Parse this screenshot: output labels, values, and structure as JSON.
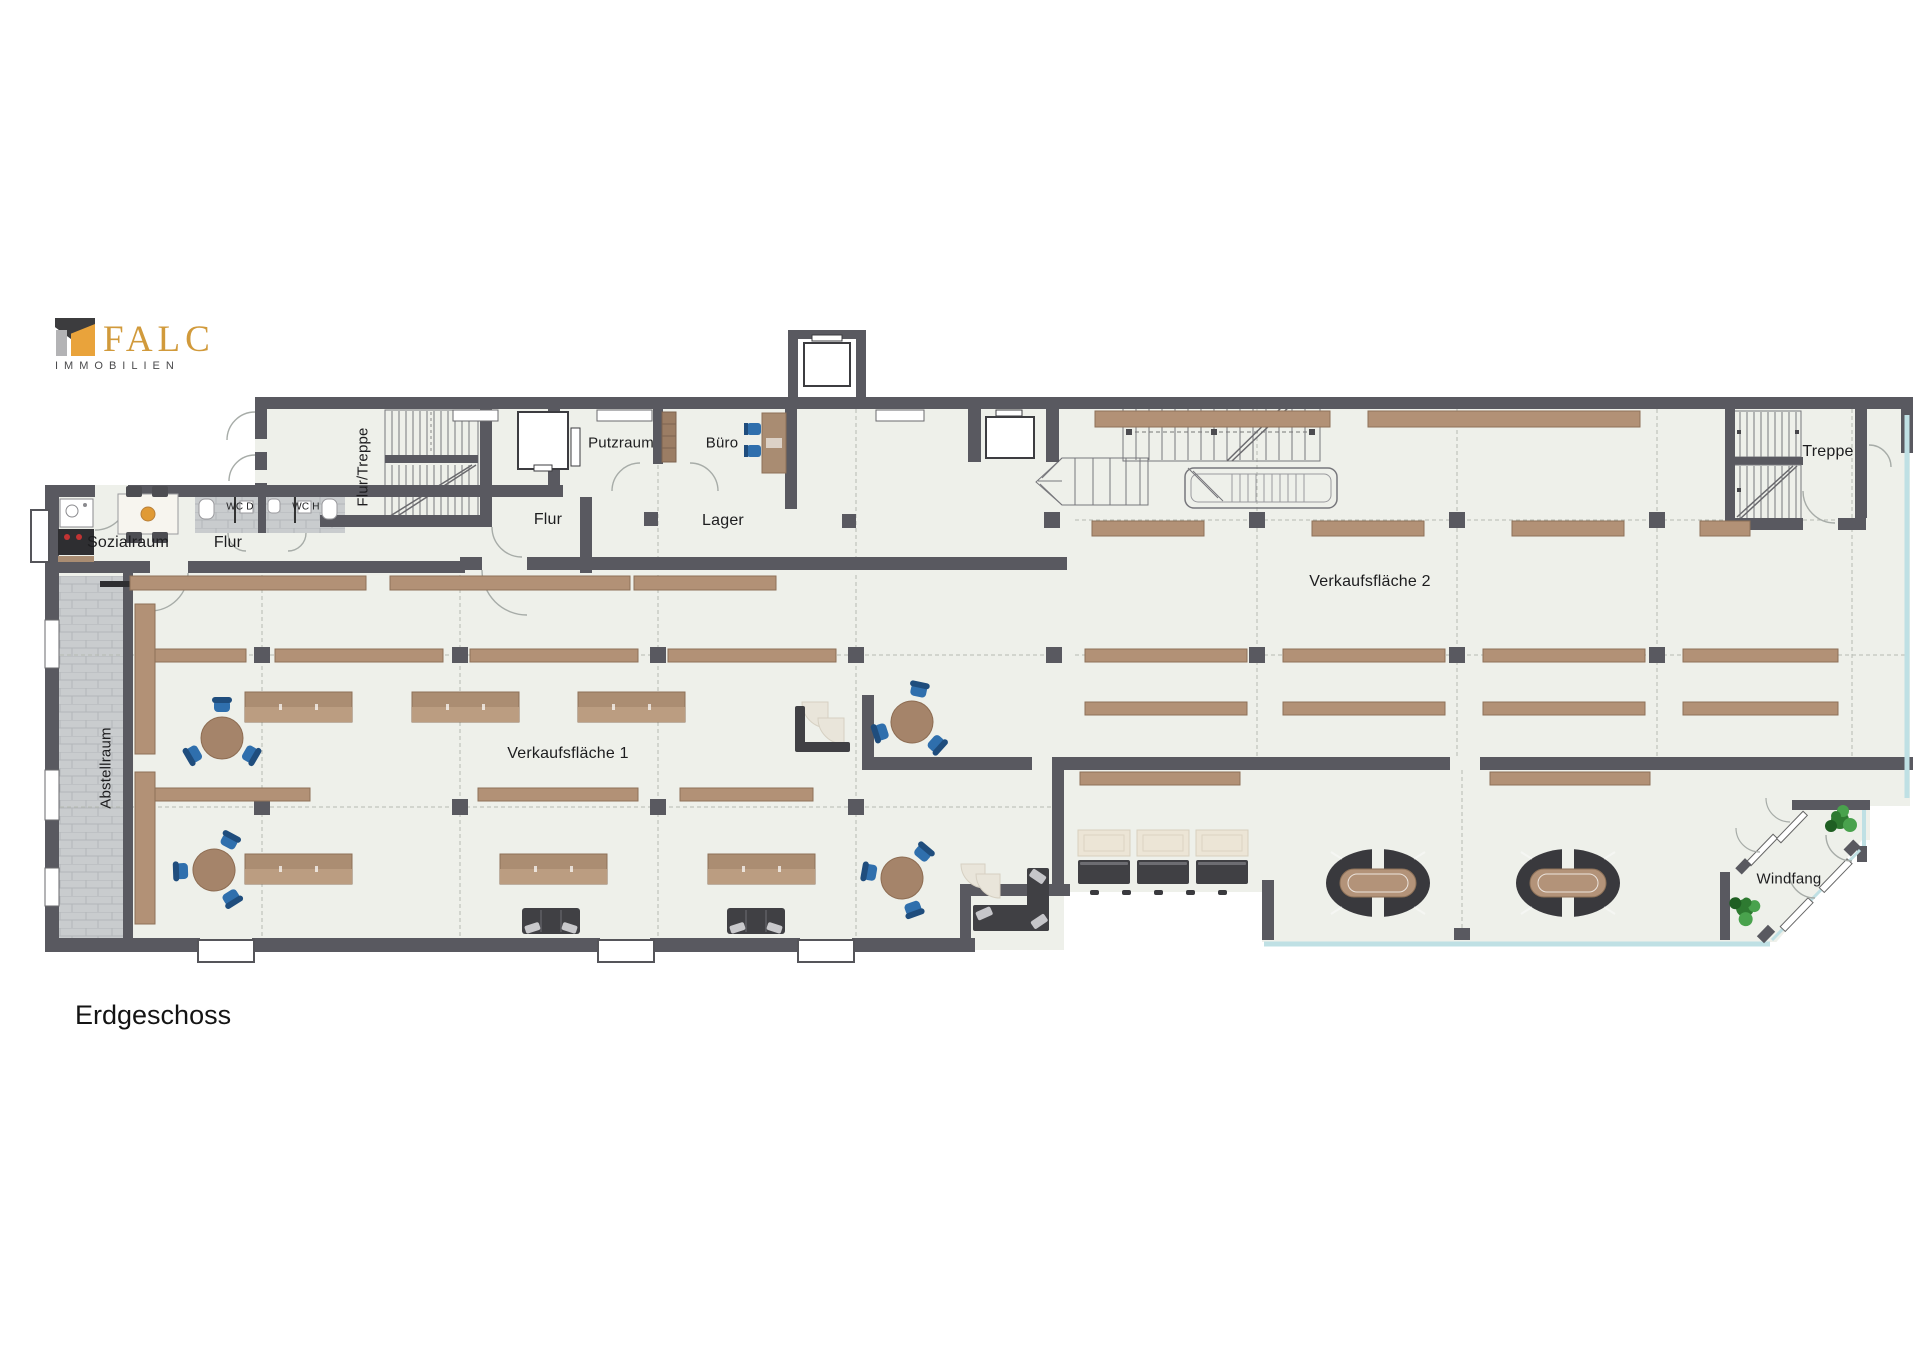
{
  "logo": {
    "brand": "FALC",
    "subtitle": "IMMOBILIEN"
  },
  "floor_title": "Erdgeschoss",
  "rooms": {
    "flur_treppe": "Flur/Treppe",
    "putzraum": "Putzraum",
    "buero": "Büro",
    "flur_mid": "Flur",
    "lager": "Lager",
    "sozialraum": "Sozialraum",
    "flur_left": "Flur",
    "wc_d": "WC D",
    "wc_h": "WC H",
    "treppe": "Treppe",
    "verkaufsflaeche_2": "Verkaufsfläche 2",
    "verkaufsflaeche_1": "Verkaufsfläche 1",
    "windfang": "Windfang",
    "abstellraum": "Abstellraum"
  },
  "palette": {
    "wall": "#595960",
    "floor": "#eef0ea",
    "tile": "#c9ccce",
    "shelf_brown": "#b29176",
    "shelf_dark": "#9a7c63",
    "furniture_dark": "#404044",
    "chair_blue": "#2f6fad",
    "table_brown": "#a5846a",
    "glass": "#bfe0e4",
    "plant_green": "#3e8f41",
    "brand_gold": "#d19a3b",
    "brand_gray": "#4a4a4c"
  }
}
